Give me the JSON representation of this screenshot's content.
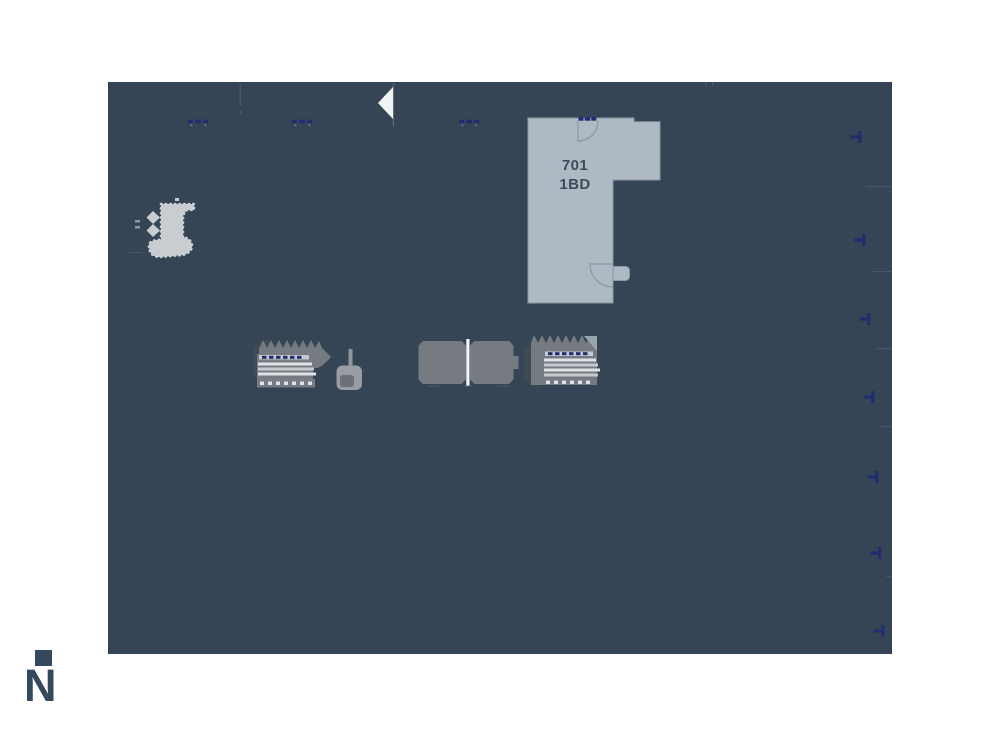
{
  "unit": {
    "number": "701",
    "type": "1BD"
  },
  "compass": {
    "label": "N"
  },
  "icons": {
    "entry_arrow": "left-pointing-triangle",
    "window_marker": "navy-dash-group",
    "balcony_marker": "navy-tick",
    "elevator_divider": "white-line"
  },
  "colors": {
    "page_bg": "#ffffff",
    "canvas_bg": "#354556",
    "unit_fill": "#aeb9c3",
    "unit_outline": "#8b99a5",
    "unit_text": "#3b4c5b",
    "core_gray": "#757b81",
    "core_dark": "#3f4a54",
    "core_light": "#c9cdd1",
    "stripe_mid": "#c3cad0",
    "stripe_light": "#dfe3e6",
    "navy_marker": "#202d6e",
    "faint_line": "#4a5c6e",
    "arrow_white": "#f2f4f4",
    "divider_white": "#f4f6f7",
    "fixture_gray": "#979da3",
    "fixture_dark": "#6b7177",
    "compass_color": "#35495c"
  }
}
